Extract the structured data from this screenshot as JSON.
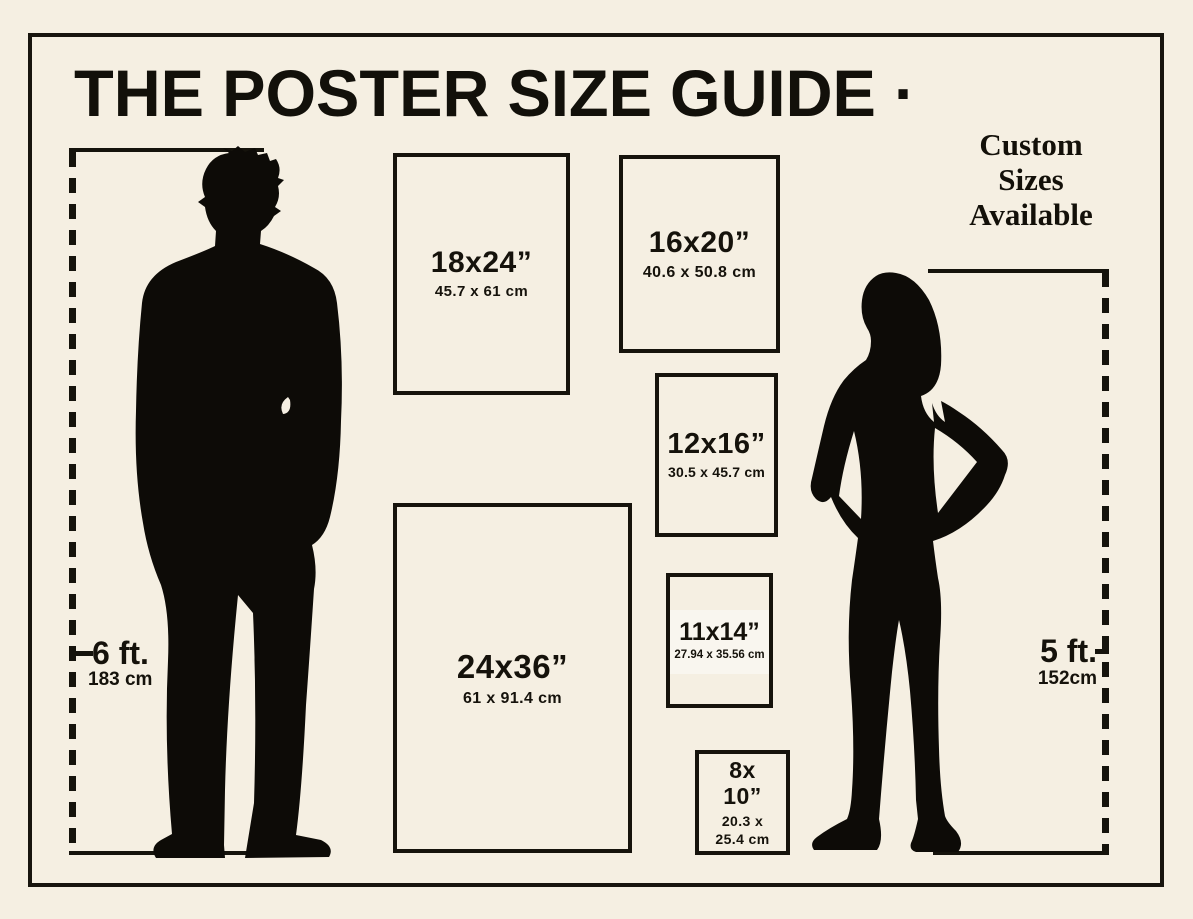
{
  "title": "THE POSTER SIZE GUIDE ·",
  "custom_note": {
    "line1": "Custom",
    "line2": "Sizes",
    "line3": "Available"
  },
  "posters": {
    "p18x24": {
      "size": "18x24”",
      "metric": "45.7 x 61 cm"
    },
    "p16x20": {
      "size": "16x20”",
      "metric": "40.6 x 50.8 cm"
    },
    "p12x16": {
      "size": "12x16”",
      "metric": "30.5 x 45.7 cm"
    },
    "p24x36": {
      "size": "24x36”",
      "metric": "61 x 91.4 cm"
    },
    "p11x14": {
      "size": "11x14”",
      "metric": "27.94 x 35.56 cm"
    },
    "p8x10": {
      "size_line1": "8x",
      "size_line2": "10”",
      "metric_line1": "20.3 x",
      "metric_line2": "25.4 cm"
    }
  },
  "height_markers": {
    "man": {
      "feet": "6 ft.",
      "cm": "183 cm"
    },
    "woman": {
      "feet": "5 ft.",
      "cm": "152cm"
    }
  },
  "colors": {
    "background": "#f5efe2",
    "ink": "#15130c"
  }
}
